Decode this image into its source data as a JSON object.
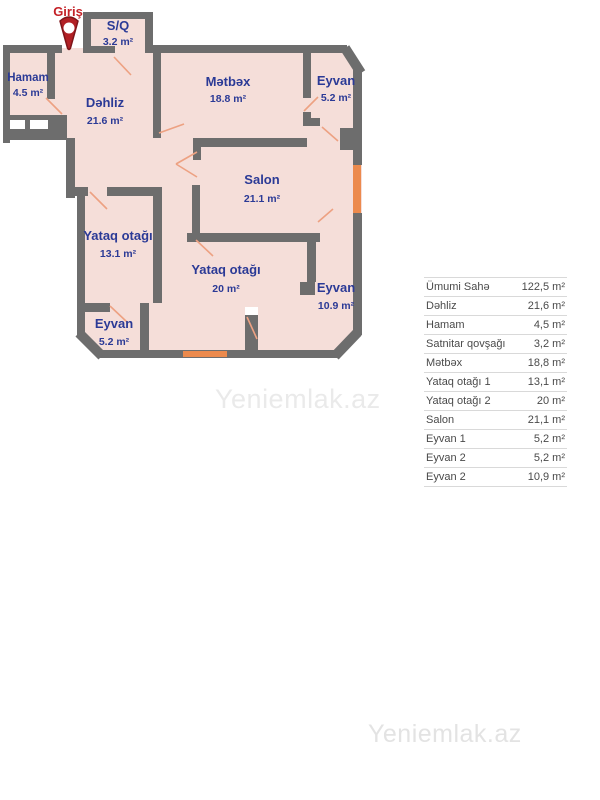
{
  "watermarks": {
    "top": "Yeniemlak.az",
    "middle": "Yeniemlak.az",
    "bottom": "Yeniemlak.az"
  },
  "floorplan": {
    "entrance_label": "Giriş",
    "rooms": [
      {
        "name": "S/Q",
        "area": "3.2 m²"
      },
      {
        "name": "Hamam",
        "area": "4.5 m²"
      },
      {
        "name": "Dəhliz",
        "area": "21.6 m²"
      },
      {
        "name": "Mətbəx",
        "area": "18.8 m²"
      },
      {
        "name": "Eyvan",
        "area": "5.2 m²"
      },
      {
        "name": "Salon",
        "area": "21.1 m²"
      },
      {
        "name": "Yataq otağı",
        "area": "13.1 m²"
      },
      {
        "name": "Yataq otağı",
        "area": "20 m²"
      },
      {
        "name": "Eyvan",
        "area": "10.9 m²"
      },
      {
        "name": "Eyvan",
        "area": "5.2 m²"
      }
    ],
    "colors": {
      "wall": "#6d6d6d",
      "room_fill": "#f5ded9",
      "door": "#eda182",
      "window": "#ec8a4d",
      "label_blue": "#2b3a96",
      "entrance_red": "#c42127",
      "watermark": "#e3e3e3",
      "table_text": "#4a4a4a",
      "table_border": "#d9d9d9"
    }
  },
  "area_table": {
    "rows": [
      {
        "label": "Ümumi Sahə",
        "value": "122,5 m²"
      },
      {
        "label": "Dəhliz",
        "value": "21,6 m²"
      },
      {
        "label": "Hamam",
        "value": "4,5 m²"
      },
      {
        "label": "Satnitar qovşağı",
        "value": "3,2 m²"
      },
      {
        "label": "Mətbəx",
        "value": "18,8 m²"
      },
      {
        "label": "Yataq otağı 1",
        "value": "13,1 m²"
      },
      {
        "label": "Yataq otağı 2",
        "value": "20 m²"
      },
      {
        "label": "Salon",
        "value": "21,1 m²"
      },
      {
        "label": "Eyvan 1",
        "value": "5,2 m²"
      },
      {
        "label": "Eyvan 2",
        "value": "5,2 m²"
      },
      {
        "label": "Eyvan 2",
        "value": "10,9 m²"
      }
    ]
  }
}
